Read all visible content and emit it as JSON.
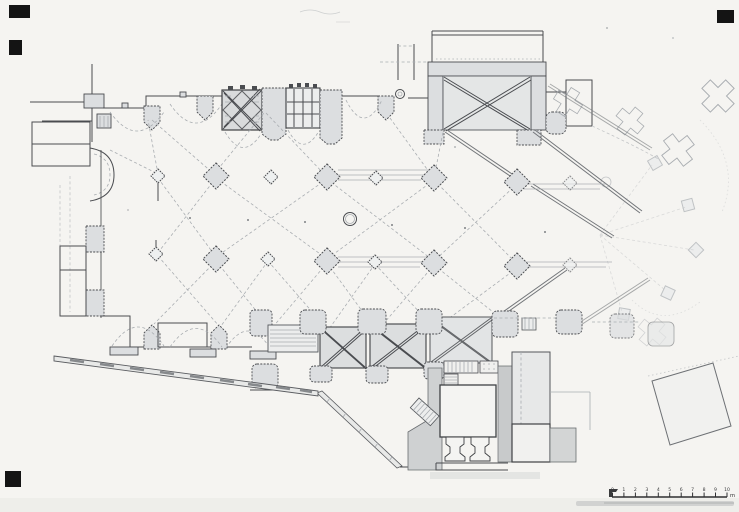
{
  "figure": {
    "kind": "architectural-floor-plan",
    "subject": "Scanned ink ground plan of a Gothic church: nave with lozenge piers, lateral chapels, vaulted tower bays, north transept, chevet with radiating buttresses, south annex buildings",
    "technique": "line drawing with gray wash on aged paper"
  },
  "palette": {
    "paper": "#f5f4f1",
    "ink": "#4a4c50",
    "ink_faint": "#a9adb1",
    "wash": "#dcdee0",
    "wash_light": "#e4e6e6",
    "registration_mark": "#141414"
  },
  "scale_bar": {
    "ticks": [
      "0",
      "1",
      "2",
      "3",
      "4",
      "5",
      "6",
      "7",
      "8",
      "9",
      "10"
    ],
    "unit": "m"
  },
  "plan_elements": {
    "west_block": "west facade rooms and turret",
    "north_chapels": "north chapel row with buttresses",
    "tower_bays": "two square vaulted bays (X-rib bay and traceried bay)",
    "north_transept": "north transept arm with diagonal-rib vault",
    "chevet": "apse hemicycle with cross-shaped buttress piers",
    "nave_arcades": "two rows of alternating large and small lozenge piers",
    "font_circle": "circular basin in mid-nave",
    "south_chapels": "south chapel row",
    "south_bays": "three X-vaulted south bays",
    "sacristy": "south annex hall with two columns and stairs",
    "boundary_wall": "long diagonal precinct wall with openings",
    "outbuilding": "detached tilted building, south-east"
  },
  "corner_marks": {
    "count": 4,
    "positions": [
      "top-left-upper",
      "top-left-lower",
      "bottom-left",
      "top-right"
    ]
  }
}
